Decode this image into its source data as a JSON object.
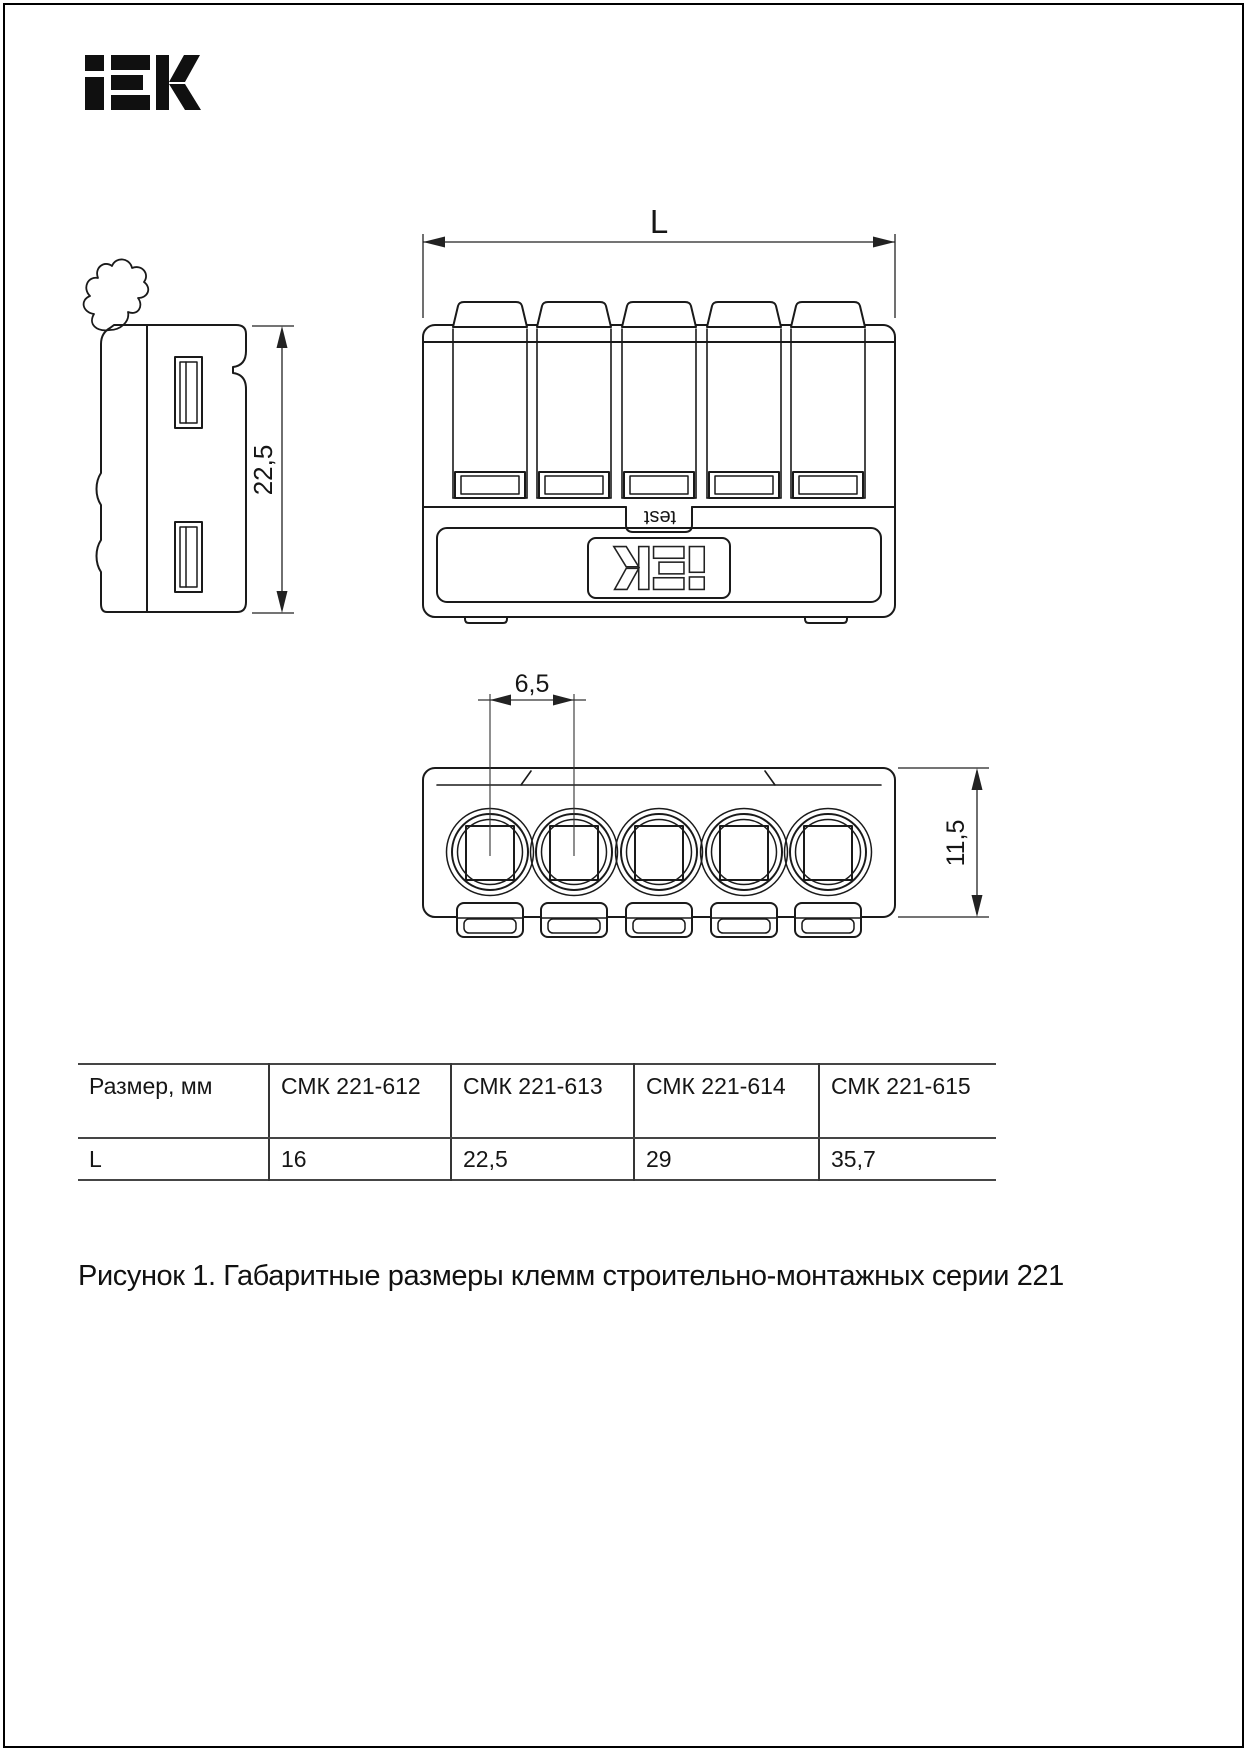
{
  "page": {
    "background": "#ffffff",
    "border_color": "#000000"
  },
  "brand": {
    "logo_text": "IEK"
  },
  "figure": {
    "caption": "Рисунок 1. Габаритные размеры клемм строительно-монтажных серии 221",
    "labels": {
      "length": "L",
      "height_mm": "22,5",
      "pitch_mm": "6,5",
      "depth_mm": "11,5",
      "test_button": "test",
      "device_logo": "iEK"
    }
  },
  "table": {
    "headers": [
      "Размер, мм",
      "СМК 221-612",
      "СМК 221-613",
      "СМК 221-614",
      "СМК 221-615"
    ],
    "rows": [
      [
        "L",
        "16",
        "22,5",
        "29",
        "35,7"
      ]
    ]
  }
}
